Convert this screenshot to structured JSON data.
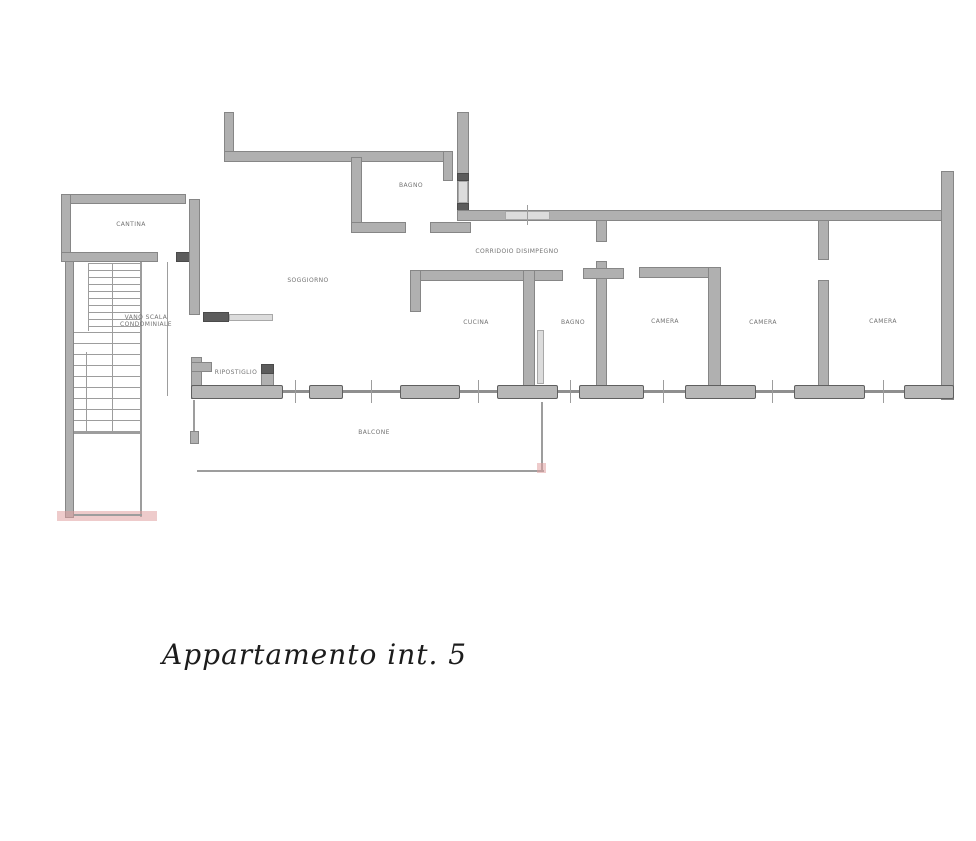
{
  "title": "Appartamento int. 5",
  "labels": {
    "cantina": "CANTINA",
    "stair_line1": "VANO SCALA",
    "stair_line2": "CONDOMINIALE",
    "soggiorno": "SOGGIORNO",
    "bagno_top": "BAGNO",
    "corridoio": "CORRIDOIO DISIMPEGNO",
    "cucina": "CUCINA",
    "bagno": "BAGNO",
    "camera1": "CAMERA",
    "camera2": "CAMERA",
    "camera3": "CAMERA",
    "ripostiglio": "RIPOSTIGLIO",
    "balcone": "BALCONE"
  },
  "colors": {
    "wall_fill": "#b0b0b0",
    "wall_edge": "#868686",
    "dark_block": "#5c5c5c",
    "artifact_pink": "#e0a0a0",
    "text": "#737373"
  }
}
